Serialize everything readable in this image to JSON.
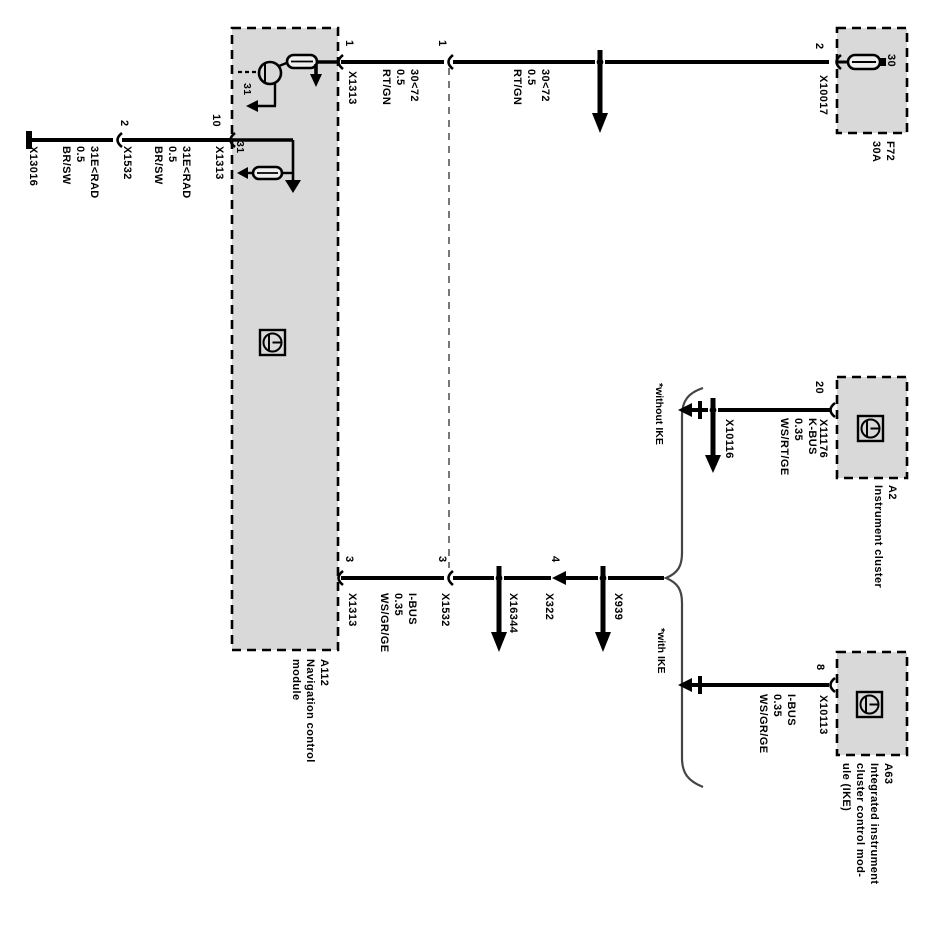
{
  "diagram_title_implied": "Navigation control module wiring",
  "colors": {
    "background": "#ffffff",
    "box_fill": "#d9d9d9",
    "line": "#000000",
    "dashed_connector_line": "#777777"
  },
  "modules": {
    "a112": {
      "label": "A112\nNavigation control\nmodule"
    },
    "a2": {
      "label": "A2\nInstrument cluster"
    },
    "a63": {
      "label": "A63\nIntegrated instrument\ncluster control mod-\nule (IKE)"
    },
    "fuse": {
      "label": "F72\n30A",
      "terminal": "30"
    }
  },
  "pins": {
    "pin1_num": "1",
    "pin1_conn": "X1313",
    "pin10_num": "10",
    "pin10_conn": "X1313",
    "pin3_num": "3",
    "pin3_conn": "X1313",
    "pin2_num": "2",
    "pin2_conn": "X10017",
    "pin20_num": "20",
    "pin20_conn": "X11176",
    "pin8_num": "8",
    "pin8_conn": "X10113"
  },
  "connectors": {
    "conn1_num": "1",
    "conn2_num": "2",
    "conn2_name": "X1532",
    "conn3_num": "3",
    "conn3_name": "X1532",
    "conn4_num": "4",
    "conn4_name": "X322",
    "ground_point": "X13016",
    "junction_top_bus": "X16344",
    "junction_mid_bus": "X939",
    "junction_kbus": "X10116"
  },
  "wires": {
    "power_left": "30<72\n0.5\nRT/GN",
    "power_right": "30<72\n0.5\nRT/GN",
    "ground_left": "31E<RAD\n0.5\nBR/SW",
    "ground_right": "31E<RAD\n0.5\nBR/SW",
    "ibus_trunk": "I-BUS\n0.35\nWS/GR/GE",
    "kbus_variant": "K-BUS\n0.35\nWS/RT/GE",
    "ibus_variant": "I-BUS\n0.35\nWS/GR/GE"
  },
  "internal": {
    "ground_ref_top": "31",
    "ground_ref_bottom": "31"
  },
  "variants": {
    "without_ike": "*without IKE",
    "with_ike": "*with IKE"
  }
}
